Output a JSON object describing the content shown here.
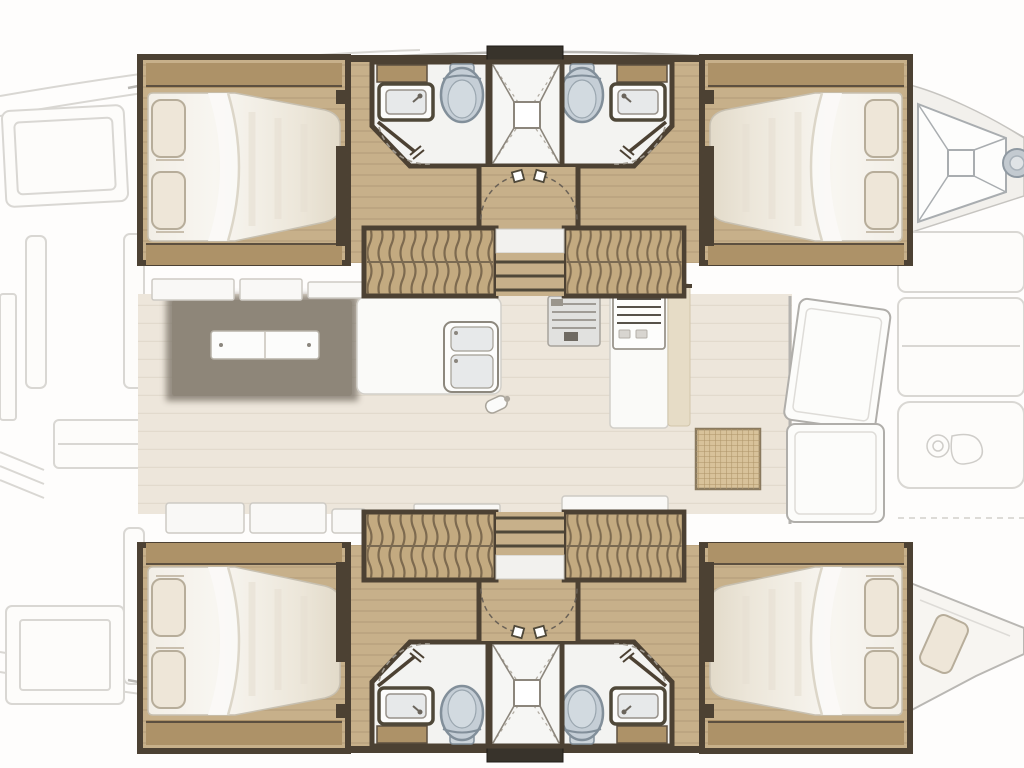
{
  "figure": {
    "kind": "floorplan",
    "subject": "catamaran-interior-layout",
    "orientation": "bow-right"
  },
  "palette": {
    "background": "#fefdfc",
    "hull_wood_floor": "#c7b08a",
    "wood_trim": "#ad9268",
    "dark_wall": "#4c4133",
    "hatch": "#38332b",
    "stair_wood": "#c3aa80",
    "stair_stripe": "#6b5a42",
    "bath_floor": "#f3f3f1",
    "toilet_fill": "#c5ced6",
    "toilet_outline": "#828f9a",
    "saloon_floor": "#ede6db",
    "mattress": "#f5f2ec",
    "mattress_shade": "#e3dccd",
    "pillow": "#eee6d8",
    "table": "#8e8679",
    "bench": "#f9f8f6",
    "faded_outline": "#d9d7d3",
    "hull_line": "#b9b7b3",
    "grating": "#d8c29a",
    "grating_line": "#ae9468",
    "basin": "#e7e9ea",
    "steel": "#c3cad0"
  },
  "plan": {
    "top_hull": {
      "aft_cabin": {
        "bed": "double-berth",
        "pillows": 2
      },
      "forward_cabin": {
        "bed": "double-berth",
        "pillows": 2
      },
      "heads": [
        {
          "fixtures": [
            "sink",
            "toilet",
            "shower"
          ]
        },
        {
          "fixtures": [
            "sink",
            "toilet",
            "shower"
          ]
        }
      ],
      "central_shower_stall": 1,
      "companionway_stairs": 2,
      "vestibule_doors": 2,
      "deck_hatches": 1
    },
    "bottom_hull": {
      "aft_cabin": {
        "bed": "double-berth",
        "pillows": 2
      },
      "forward_cabin": {
        "bed": "double-berth",
        "pillows": 2
      },
      "heads": [
        {
          "fixtures": [
            "sink",
            "toilet",
            "shower"
          ]
        },
        {
          "fixtures": [
            "sink",
            "toilet",
            "shower"
          ]
        }
      ],
      "central_shower_stall": 1,
      "companionway_stairs": 2,
      "vestibule_doors": 2,
      "deck_hatches": 1
    },
    "saloon": {
      "dining_table": 1,
      "table_leaves": 2,
      "benches": 8,
      "galley": {
        "sink_basins": 2,
        "stove": 1,
        "counters": 2
      },
      "nav_panel": 1,
      "front_door_leaves": 2,
      "floor_grating": 1
    },
    "exterior": {
      "bow_anchor_locker": 1,
      "bow_winch": 1,
      "bow_berth_pillows": 1,
      "foredeck_pads": 3,
      "aft_deck_pads": 4
    }
  }
}
